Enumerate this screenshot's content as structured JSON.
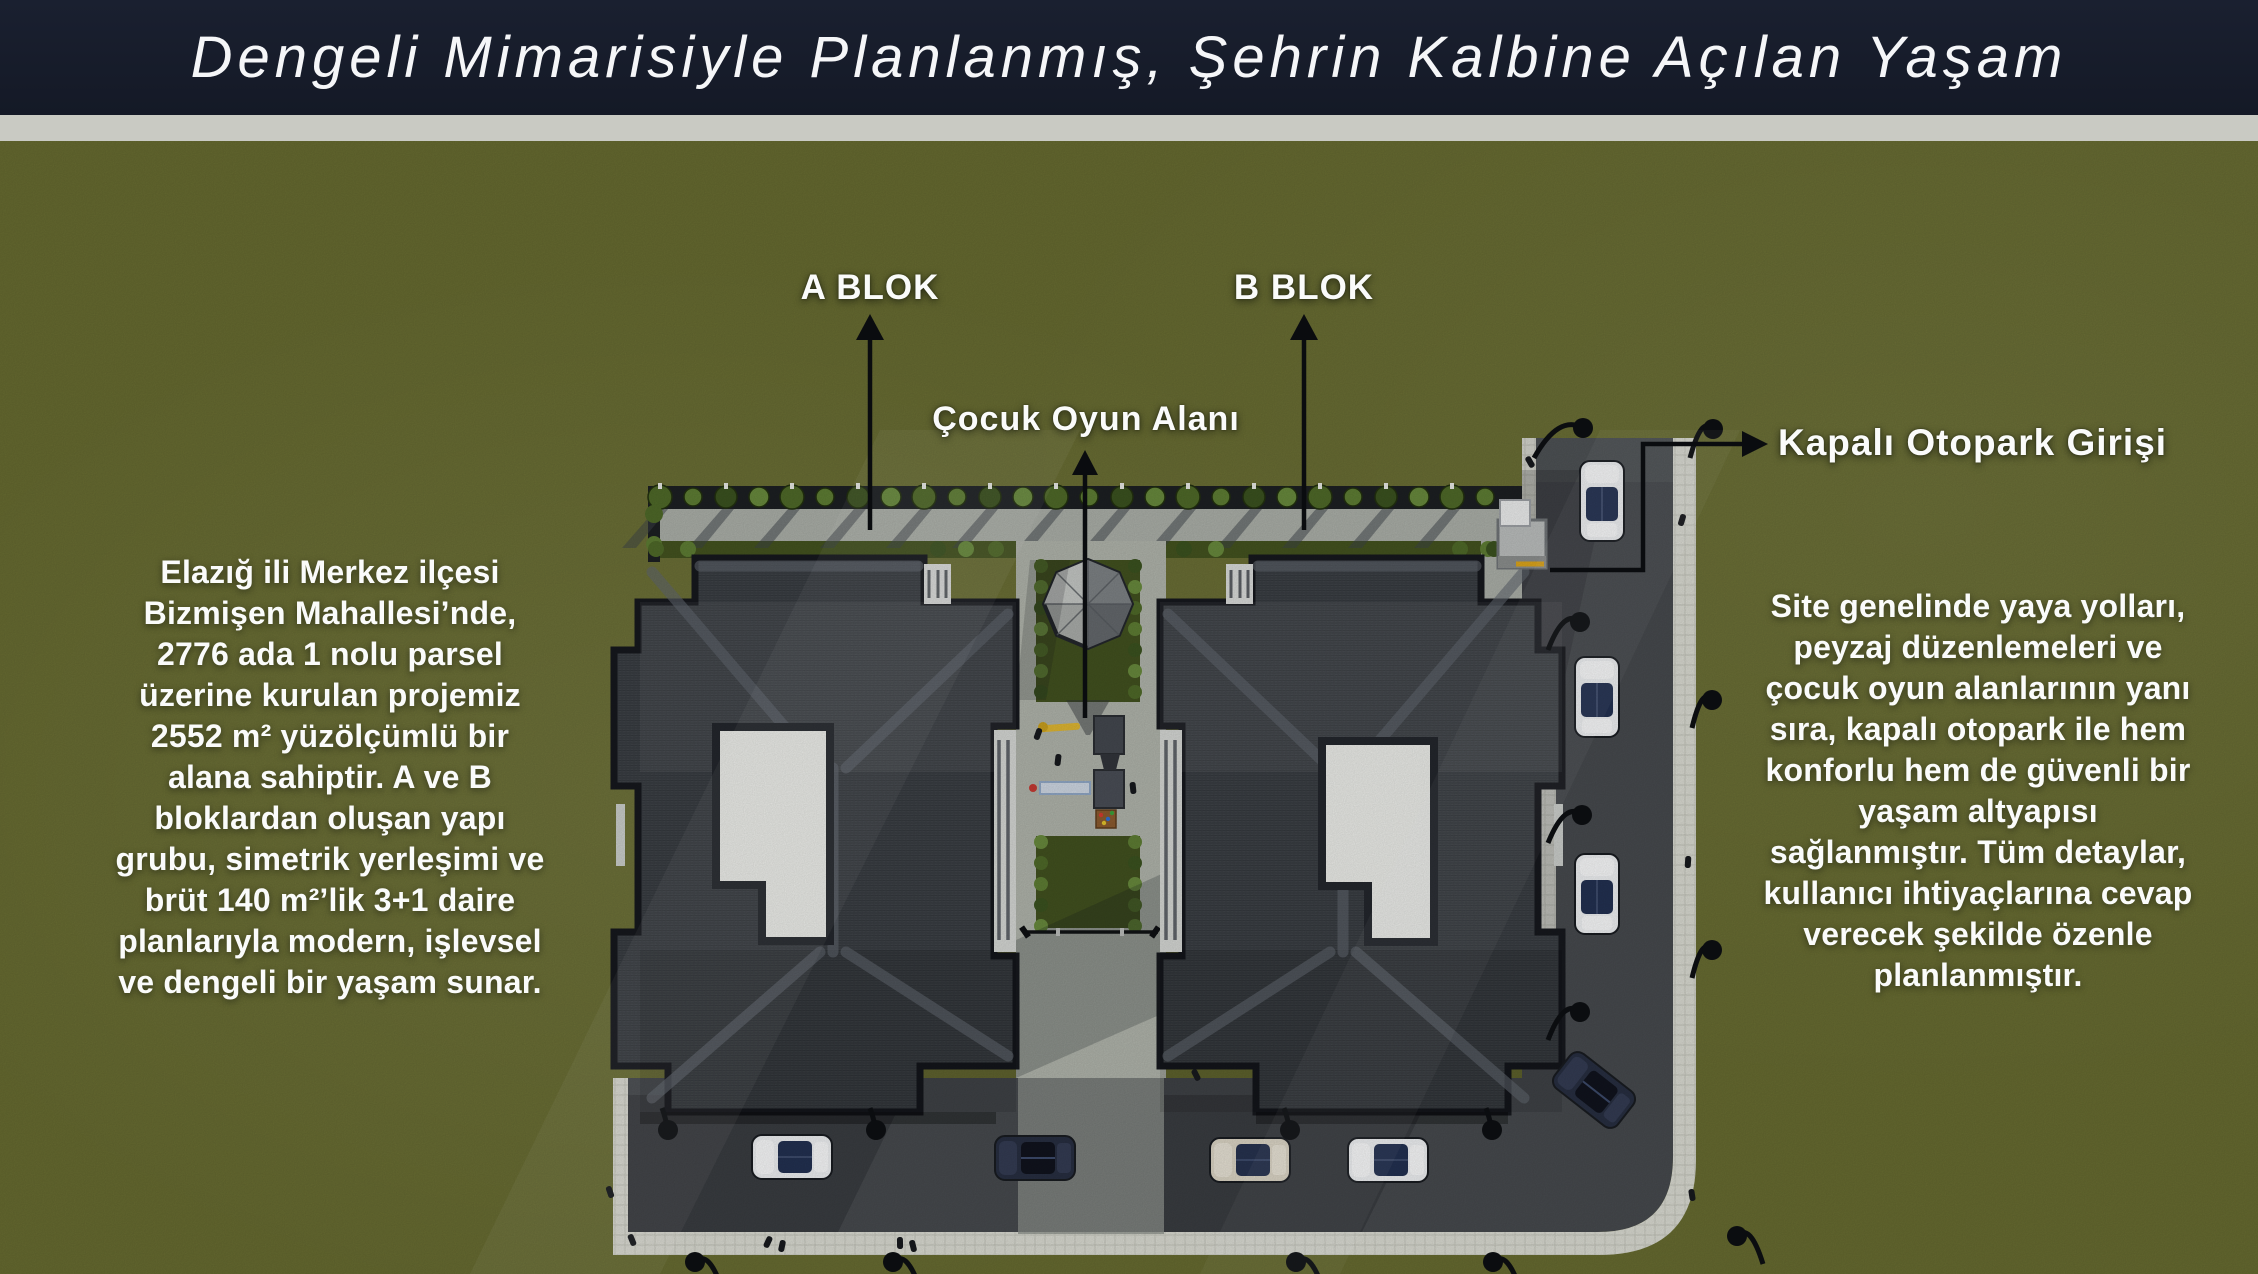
{
  "header": {
    "title": "Dengeli Mimarisiyle Planlanmış, Şehrin Kalbine Açılan Yaşam"
  },
  "annotations": {
    "block_a": "A BLOK",
    "block_b": "B BLOK",
    "playground": "Çocuk Oyun Alanı",
    "garage": "Kapalı Otopark Girişi"
  },
  "left_description": [
    "Elazığ ili Merkez ilçesi",
    "Bizmişen Mahallesi’nde,",
    "2776 ada 1 nolu parsel",
    "üzerine kurulan projemiz",
    "2552 m² yüzölçümlü bir",
    "alana sahiptir. A ve B",
    "bloklardan oluşan yapı",
    "grubu, simetrik yerleşimi ve",
    "brüt 140 m²’lik 3+1 daire",
    "planlarıyla modern, işlevsel",
    "ve dengeli bir yaşam sunar."
  ],
  "right_description": [
    "Site genelinde yaya yolları,",
    "peyzaj düzenlemeleri ve",
    "çocuk oyun alanlarının yanı",
    "sıra, kapalı otopark ile hem",
    "konforlu hem de güvenli bir",
    "yaşam altyapısı",
    "sağlanmıştır. Tüm detaylar,",
    "kullanıcı ihtiyaçlarına cevap",
    "verecek şekilde özenle",
    "planlanmıştır."
  ],
  "colors": {
    "olive": "#666a30",
    "header": "#1a2030",
    "divider": "#c9cac3",
    "title-color": "#f5f6f8",
    "label-color": "#fafbfa",
    "asphalt": "#46494d",
    "sidewalk": "#d8d9d0",
    "roof": "#3e4247",
    "lawn": "#41501f",
    "atrium": "#e9eae6",
    "leader-line": "#0c0e11"
  }
}
